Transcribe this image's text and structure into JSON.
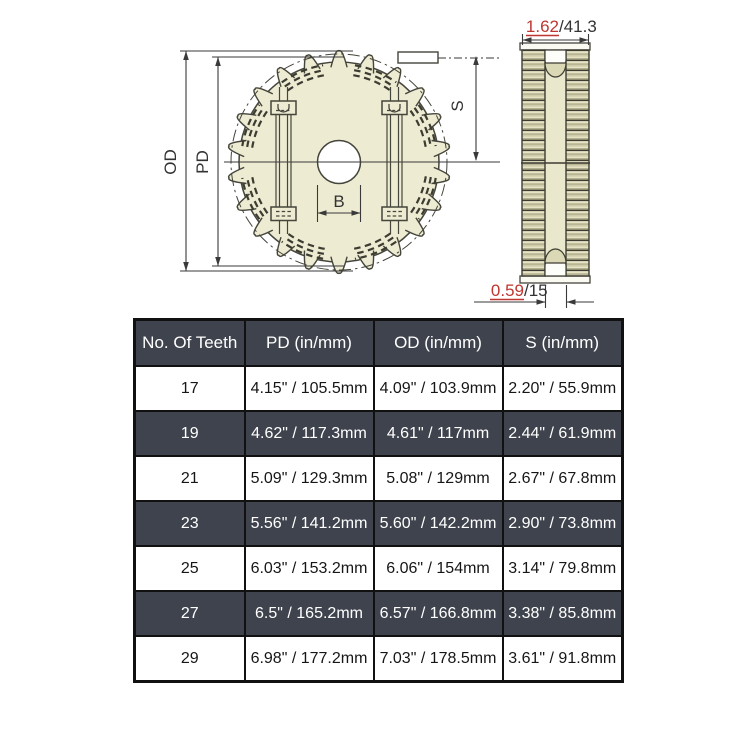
{
  "drawing": {
    "front_view": {
      "od_label": "OD",
      "pd_label": "PD",
      "bore_label": "B",
      "s_label": "S"
    },
    "side_view": {
      "width_dim": {
        "inch": "1.62",
        "mm": "/41.3"
      },
      "groove_dim": {
        "inch": "0.59",
        "mm": "/15"
      }
    },
    "colors": {
      "body_fill": "#edebd1",
      "outline": "#45453c",
      "dim_red": "#bf3630",
      "dim_dark": "#3a3a3a"
    }
  },
  "table": {
    "headers": [
      "No. Of Teeth",
      "PD (in/mm)",
      "OD (in/mm)",
      "S (in/mm)"
    ],
    "rows": [
      [
        "17",
        "4.15\" / 105.5mm",
        "4.09\" / 103.9mm",
        "2.20\" / 55.9mm"
      ],
      [
        "19",
        "4.62\" / 117.3mm",
        "4.61\" / 117mm",
        "2.44\" / 61.9mm"
      ],
      [
        "21",
        "5.09\" / 129.3mm",
        "5.08\" / 129mm",
        "2.67\" / 67.8mm"
      ],
      [
        "23",
        "5.56\" / 141.2mm",
        "5.60\" / 142.2mm",
        "2.90\" / 73.8mm"
      ],
      [
        "25",
        "6.03\" / 153.2mm",
        "6.06\" / 154mm",
        "3.14\" / 79.8mm"
      ],
      [
        "27",
        "6.5\" / 165.2mm",
        "6.57\" / 166.8mm",
        "3.38\" / 85.8mm"
      ],
      [
        "29",
        "6.98\" / 177.2mm",
        "7.03\" / 178.5mm",
        "3.61\" / 91.8mm"
      ]
    ],
    "colors": {
      "header_bg": "#3f434d",
      "alt_row_bg": "#3f434d",
      "row_bg": "#ffffff"
    }
  }
}
